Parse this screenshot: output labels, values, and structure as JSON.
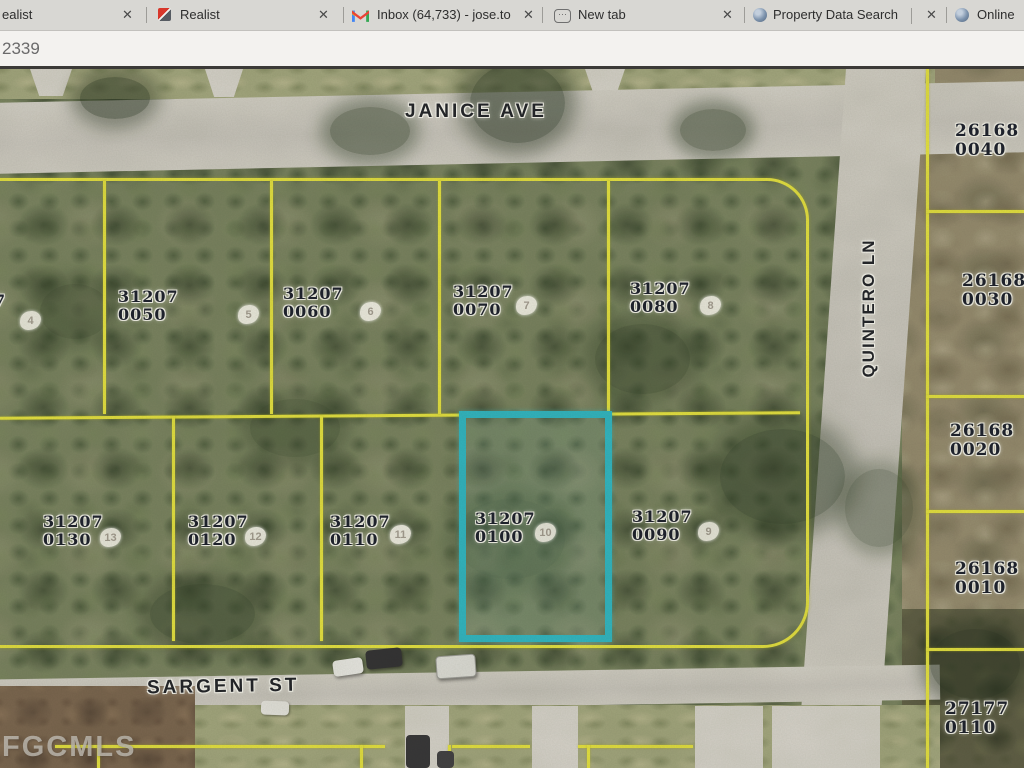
{
  "browser": {
    "close_glyph": "✕",
    "new_tab_glyph": "⋯",
    "address_fragment": "2339",
    "tabs": [
      {
        "label": "ealist",
        "icon": "none",
        "partial": true
      },
      {
        "label": "Realist",
        "icon": "realist-logo"
      },
      {
        "label": "Inbox (64,733) - jose.to",
        "icon": "gmail"
      },
      {
        "label": "New tab",
        "icon": "new-tab"
      },
      {
        "label": "Property Data Search",
        "icon": "globe"
      },
      {
        "label": "Online",
        "icon": "globe",
        "partial": true
      }
    ]
  },
  "map": {
    "watermark": "FGCMLS",
    "highlighted_parcel": "31207 0100",
    "colors": {
      "parcel_line": "#e4e13a",
      "highlight": "#2ab5c3"
    },
    "streets": [
      {
        "name": "JANICE AVE"
      },
      {
        "name": "QUINTERO LN"
      },
      {
        "name": "SARGENT ST"
      }
    ],
    "parcels": [
      {
        "line1": "31207",
        "line2": "0050",
        "lot": "5"
      },
      {
        "line1": "31207",
        "line2": "0060",
        "lot": "6"
      },
      {
        "line1": "31207",
        "line2": "0070",
        "lot": "7"
      },
      {
        "line1": "31207",
        "line2": "0080",
        "lot": "8"
      },
      {
        "line1": "31207",
        "line2": "0130",
        "lot": "13"
      },
      {
        "line1": "31207",
        "line2": "0120",
        "lot": "12"
      },
      {
        "line1": "31207",
        "line2": "0110",
        "lot": "11"
      },
      {
        "line1": "31207",
        "line2": "0100",
        "lot": "10"
      },
      {
        "line1": "31207",
        "line2": "0090",
        "lot": "9"
      },
      {
        "line1": "26168",
        "line2": "0040"
      },
      {
        "line1": "26168",
        "line2": "0030"
      },
      {
        "line1": "26168",
        "line2": "0020"
      },
      {
        "line1": "26168",
        "line2": "0010"
      },
      {
        "line1": "27177",
        "line2": "0110"
      },
      {
        "line1": "7",
        "line2": "",
        "lot": "4"
      }
    ]
  }
}
